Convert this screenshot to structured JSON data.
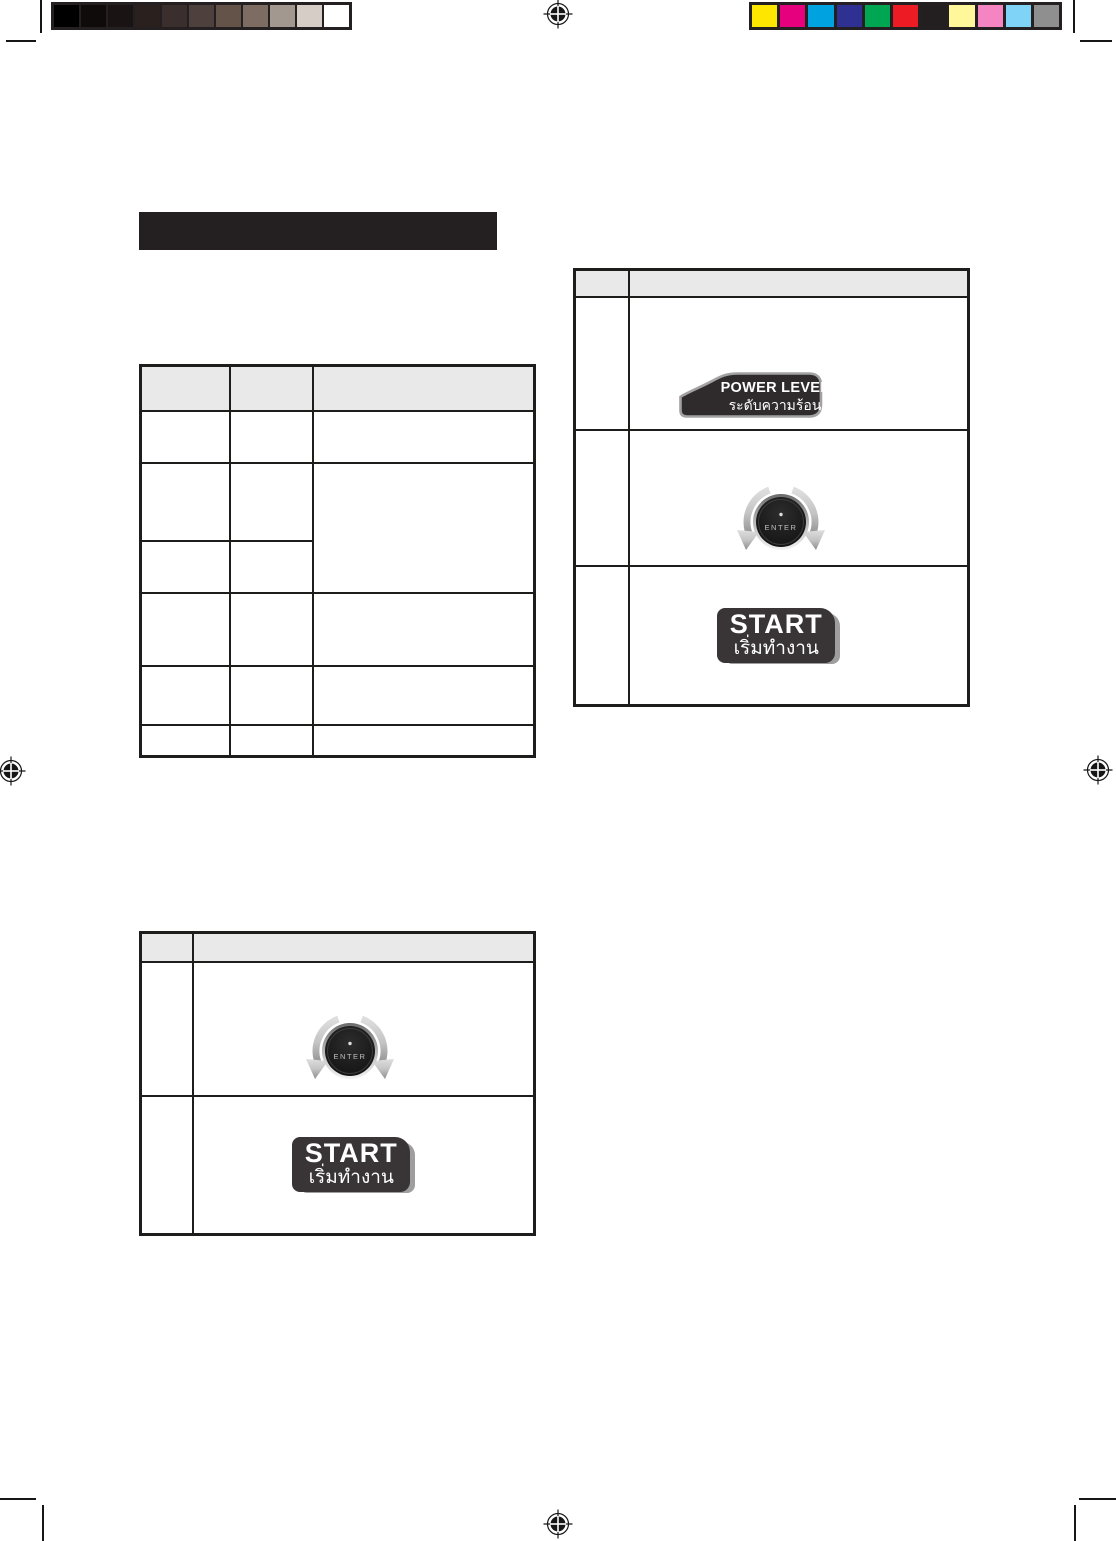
{
  "page": {
    "width": 1116,
    "height": 1541
  },
  "print_calibration": {
    "grayscale_steps": [
      "#000000",
      "#0e0b0a",
      "#191413",
      "#2a211f",
      "#3b2f2d",
      "#4e403c",
      "#635349",
      "#7d6c62",
      "#a3988f",
      "#d6cdc7",
      "#ffffff"
    ],
    "color_steps": [
      "#ffe600",
      "#e6007e",
      "#00a3e0",
      "#2e3192",
      "#00a651",
      "#ed1c24",
      "#231f20",
      "#fff799",
      "#f584c3",
      "#7fd3f7",
      "#8f8f8f"
    ]
  },
  "title_bar": {
    "color": "#241f20"
  },
  "table_style": {
    "header_fill": "#e9e9e9",
    "border_color": "#1d1d1b"
  },
  "controls": {
    "power_level_button": {
      "label_en": "POWER LEVEL",
      "label_th": "ระดับความร้อน"
    },
    "enter_dial": {
      "label": "ENTER"
    },
    "start_button": {
      "label_en": "START",
      "label_th": "เริ่มทำงาน"
    }
  }
}
